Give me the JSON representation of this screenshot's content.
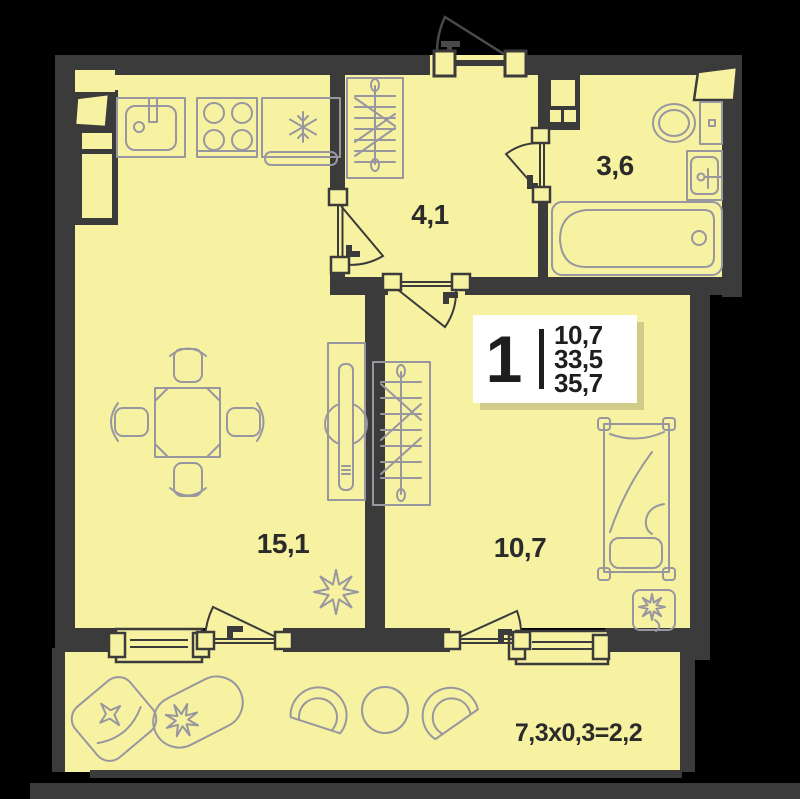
{
  "badge": {
    "rooms": "1",
    "values": [
      "10,7",
      "33,5",
      "35,7"
    ]
  },
  "rooms": {
    "hallway": {
      "label": "4,1"
    },
    "bathroom": {
      "label": "3,6"
    },
    "living_kitchen": {
      "label": "15,1"
    },
    "bedroom": {
      "label": "10,7"
    },
    "balcony": {
      "label": "7,3x0,3=2,2"
    }
  },
  "colors": {
    "background": "#000000",
    "walls": "#3c3b3b",
    "floor": "#f7f2a2",
    "furniture_outline": "#98979f",
    "door_lines": "#3c3b3b",
    "text": "#2b2b2b",
    "badge_background": "#ffffff"
  },
  "icons": [
    "kitchen-sink-icon",
    "stove-burners-icon",
    "fridge-snowflake-icon",
    "wardrobe-hangers-icon",
    "dining-table-icon",
    "chair-icon",
    "cabinet-icon",
    "flower-plant-icon",
    "bed-icon",
    "toilet-icon",
    "washbasin-icon",
    "bathtub-icon",
    "armchair-icon",
    "planter-icon",
    "balcony-chair-icon",
    "balcony-table-icon",
    "door-swing-icon",
    "window-icon"
  ]
}
